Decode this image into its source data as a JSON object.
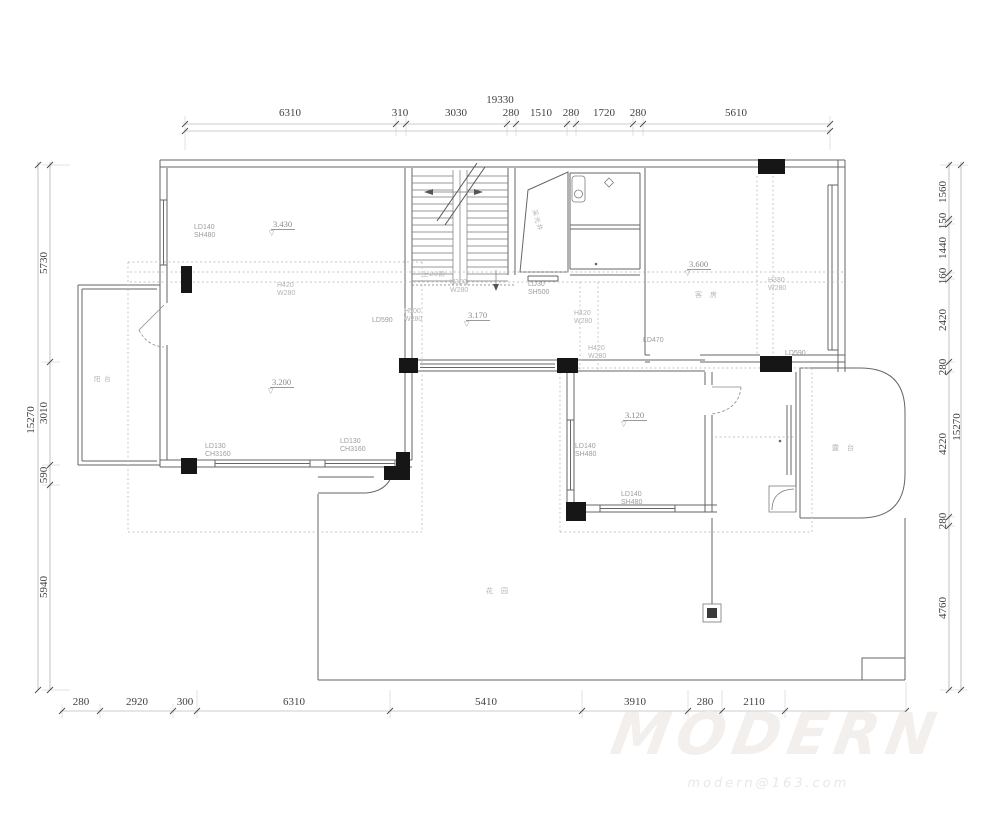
{
  "dims": {
    "top": {
      "total": "19330",
      "segments": [
        "6310",
        "310",
        "3030",
        "280",
        "1510",
        "280",
        "1720",
        "280",
        "5610"
      ]
    },
    "bottom": {
      "segments": [
        "280",
        "2920",
        "300",
        "6310",
        "5410",
        "3910",
        "280",
        "2110"
      ]
    },
    "left": {
      "total": "15270",
      "segments": [
        "5730",
        "3010",
        "590",
        "5940"
      ]
    },
    "right": {
      "total": "15270",
      "segments": [
        "1560",
        "150",
        "1440",
        "160",
        "2420",
        "280",
        "4220",
        "280",
        "4760"
      ]
    }
  },
  "elevations": {
    "e1": "3.430",
    "e2": "3.600",
    "e3": "3.170",
    "e4": "3.200",
    "e5": "3.120"
  },
  "labels": {
    "ld140_sh480_a": {
      "l1": "LD140",
      "l2": "SH480"
    },
    "ld140_sh480_b": {
      "l1": "LD140",
      "l2": "SH480"
    },
    "ld140_sh480_c": {
      "l1": "LD140",
      "l2": "SH480"
    },
    "ld130_ch3160_a": {
      "l1": "LD130",
      "l2": "CH3160"
    },
    "ld130_ch3160_b": {
      "l1": "LD130",
      "l2": "CH3160"
    },
    "ld30_sh500": {
      "l1": "LD30",
      "l2": "SH500"
    },
    "h420_w280_a": {
      "l1": "H420",
      "l2": "W280"
    },
    "h420_w280_b": {
      "l1": "H420",
      "l2": "W280"
    },
    "h420_w280_c": {
      "l1": "H420",
      "l2": "W280"
    },
    "h380_w280": {
      "l1": "H380",
      "l2": "W280"
    },
    "h500_w280": {
      "l1": "H500",
      "l2": "W280"
    },
    "h300_w280": {
      "l1": "H300",
      "l2": "W280"
    },
    "ld470": "LD470",
    "ld590_a": "LD590",
    "ld590_b": "LD590"
  },
  "rooms": {
    "guest_room": "客 房",
    "terrace": "露 台",
    "balcony": "阳 台",
    "garden": "花 园",
    "light_well": "采光井",
    "stairs_up": "上20阶"
  },
  "watermark": {
    "logo": "MODERN",
    "sub": "modern@163.com"
  }
}
